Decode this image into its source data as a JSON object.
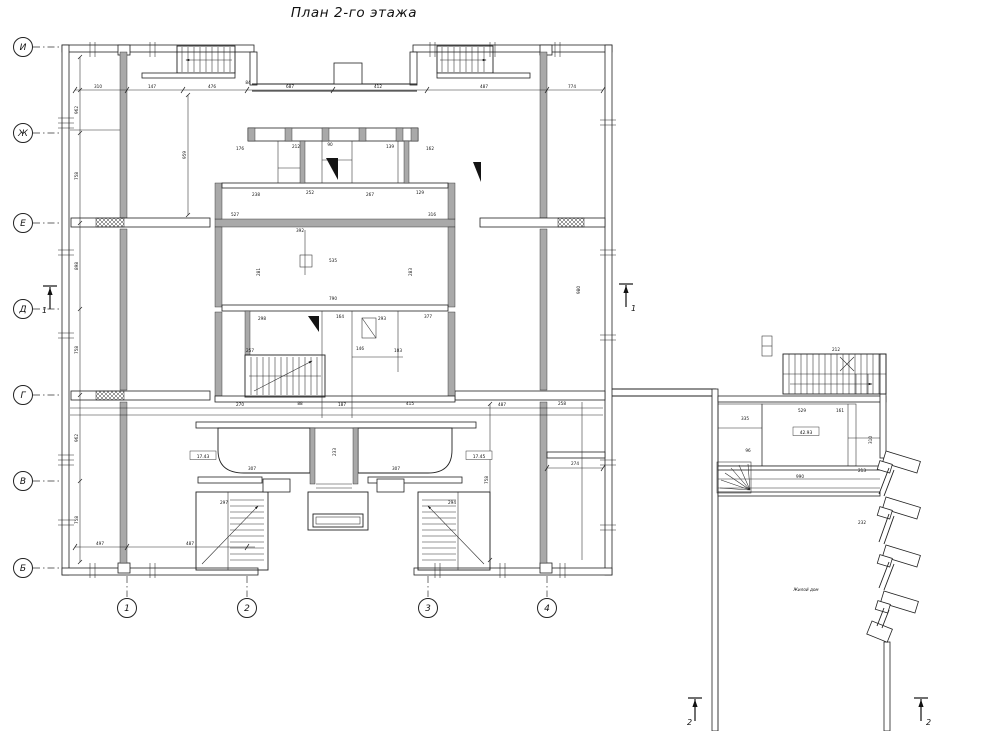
{
  "title": "План 2-го этажа",
  "colors": {
    "line": "#222222",
    "wall_fill": "#a9a9a9",
    "background": "#ffffff"
  },
  "axis_letters": [
    {
      "label": "И",
      "y": 47
    },
    {
      "label": "Ж",
      "y": 133
    },
    {
      "label": "Е",
      "y": 223
    },
    {
      "label": "Д",
      "y": 309
    },
    {
      "label": "Г",
      "y": 395
    },
    {
      "label": "В",
      "y": 481
    },
    {
      "label": "Б",
      "y": 568
    }
  ],
  "axis_numbers": [
    {
      "label": "1",
      "x": 127
    },
    {
      "label": "2",
      "x": 247
    },
    {
      "label": "3",
      "x": 428
    },
    {
      "label": "4",
      "x": 547
    }
  ],
  "section_marks": [
    {
      "label": "1",
      "x": 50,
      "y": 286,
      "ldx": -8
    },
    {
      "label": "1",
      "x": 626,
      "y": 284,
      "ldx": 5
    },
    {
      "label": "2",
      "x": 695,
      "y": 698,
      "ldx": -8
    },
    {
      "label": "2",
      "x": 921,
      "y": 698,
      "ldx": 5
    }
  ],
  "room_labels": [
    {
      "text": "17.43",
      "x": 203,
      "y": 457
    },
    {
      "text": "17.45",
      "x": 479,
      "y": 457
    },
    {
      "text": "42.93",
      "x": 806,
      "y": 433
    }
  ],
  "annex_note": {
    "text": "Жилой дом",
    "x": 806,
    "y": 591
  },
  "dim_labels": [
    {
      "t": "310",
      "x": 98,
      "y": 88
    },
    {
      "t": "147",
      "x": 152,
      "y": 88
    },
    {
      "t": "476",
      "x": 212,
      "y": 88
    },
    {
      "t": "84",
      "x": 248,
      "y": 84
    },
    {
      "t": "687",
      "x": 290,
      "y": 88
    },
    {
      "t": "412",
      "x": 378,
      "y": 88
    },
    {
      "t": "487",
      "x": 484,
      "y": 88
    },
    {
      "t": "774",
      "x": 572,
      "y": 88
    },
    {
      "t": "962",
      "x": 78,
      "y": 110,
      "r": 1
    },
    {
      "t": "758",
      "x": 78,
      "y": 176,
      "r": 1
    },
    {
      "t": "898",
      "x": 78,
      "y": 266,
      "r": 1
    },
    {
      "t": "758",
      "x": 78,
      "y": 350,
      "r": 1
    },
    {
      "t": "962",
      "x": 78,
      "y": 438,
      "r": 1
    },
    {
      "t": "758",
      "x": 78,
      "y": 520,
      "r": 1
    },
    {
      "t": "959",
      "x": 186,
      "y": 155,
      "r": 1
    },
    {
      "t": "758",
      "x": 488,
      "y": 480,
      "r": 1
    },
    {
      "t": "497",
      "x": 100,
      "y": 545
    },
    {
      "t": "487",
      "x": 190,
      "y": 545
    },
    {
      "t": "274",
      "x": 575,
      "y": 465
    },
    {
      "t": "980",
      "x": 580,
      "y": 290,
      "r": 1
    },
    {
      "t": "176",
      "x": 240,
      "y": 150
    },
    {
      "t": "212",
      "x": 296,
      "y": 148
    },
    {
      "t": "90",
      "x": 330,
      "y": 146
    },
    {
      "t": "139",
      "x": 390,
      "y": 148
    },
    {
      "t": "162",
      "x": 430,
      "y": 150
    },
    {
      "t": "238",
      "x": 256,
      "y": 196
    },
    {
      "t": "252",
      "x": 310,
      "y": 194
    },
    {
      "t": "267",
      "x": 370,
      "y": 196
    },
    {
      "t": "129",
      "x": 420,
      "y": 194
    },
    {
      "t": "527",
      "x": 235,
      "y": 216
    },
    {
      "t": "392",
      "x": 300,
      "y": 232
    },
    {
      "t": "316",
      "x": 432,
      "y": 216
    },
    {
      "t": "535",
      "x": 333,
      "y": 262
    },
    {
      "t": "790",
      "x": 333,
      "y": 300
    },
    {
      "t": "281",
      "x": 260,
      "y": 272,
      "r": 1
    },
    {
      "t": "283",
      "x": 412,
      "y": 272,
      "r": 1
    },
    {
      "t": "298",
      "x": 262,
      "y": 320
    },
    {
      "t": "164",
      "x": 340,
      "y": 318
    },
    {
      "t": "293",
      "x": 382,
      "y": 320
    },
    {
      "t": "377",
      "x": 428,
      "y": 318
    },
    {
      "t": "257",
      "x": 250,
      "y": 352
    },
    {
      "t": "146",
      "x": 360,
      "y": 350
    },
    {
      "t": "103",
      "x": 398,
      "y": 352
    },
    {
      "t": "270",
      "x": 240,
      "y": 406
    },
    {
      "t": "88",
      "x": 300,
      "y": 405
    },
    {
      "t": "187",
      "x": 342,
      "y": 406
    },
    {
      "t": "415",
      "x": 410,
      "y": 405
    },
    {
      "t": "487",
      "x": 502,
      "y": 406
    },
    {
      "t": "258",
      "x": 562,
      "y": 405
    },
    {
      "t": "307",
      "x": 252,
      "y": 470
    },
    {
      "t": "307",
      "x": 396,
      "y": 470
    },
    {
      "t": "233",
      "x": 336,
      "y": 452,
      "r": 1
    },
    {
      "t": "297",
      "x": 224,
      "y": 504
    },
    {
      "t": "294",
      "x": 452,
      "y": 504
    },
    {
      "t": "335",
      "x": 745,
      "y": 420
    },
    {
      "t": "529",
      "x": 802,
      "y": 412
    },
    {
      "t": "161",
      "x": 840,
      "y": 412
    },
    {
      "t": "990",
      "x": 800,
      "y": 478
    },
    {
      "t": "213",
      "x": 862,
      "y": 472
    },
    {
      "t": "310",
      "x": 872,
      "y": 440,
      "r": 1
    },
    {
      "t": "96",
      "x": 748,
      "y": 452
    },
    {
      "t": "212",
      "x": 836,
      "y": 351
    },
    {
      "t": "232",
      "x": 862,
      "y": 524
    }
  ]
}
